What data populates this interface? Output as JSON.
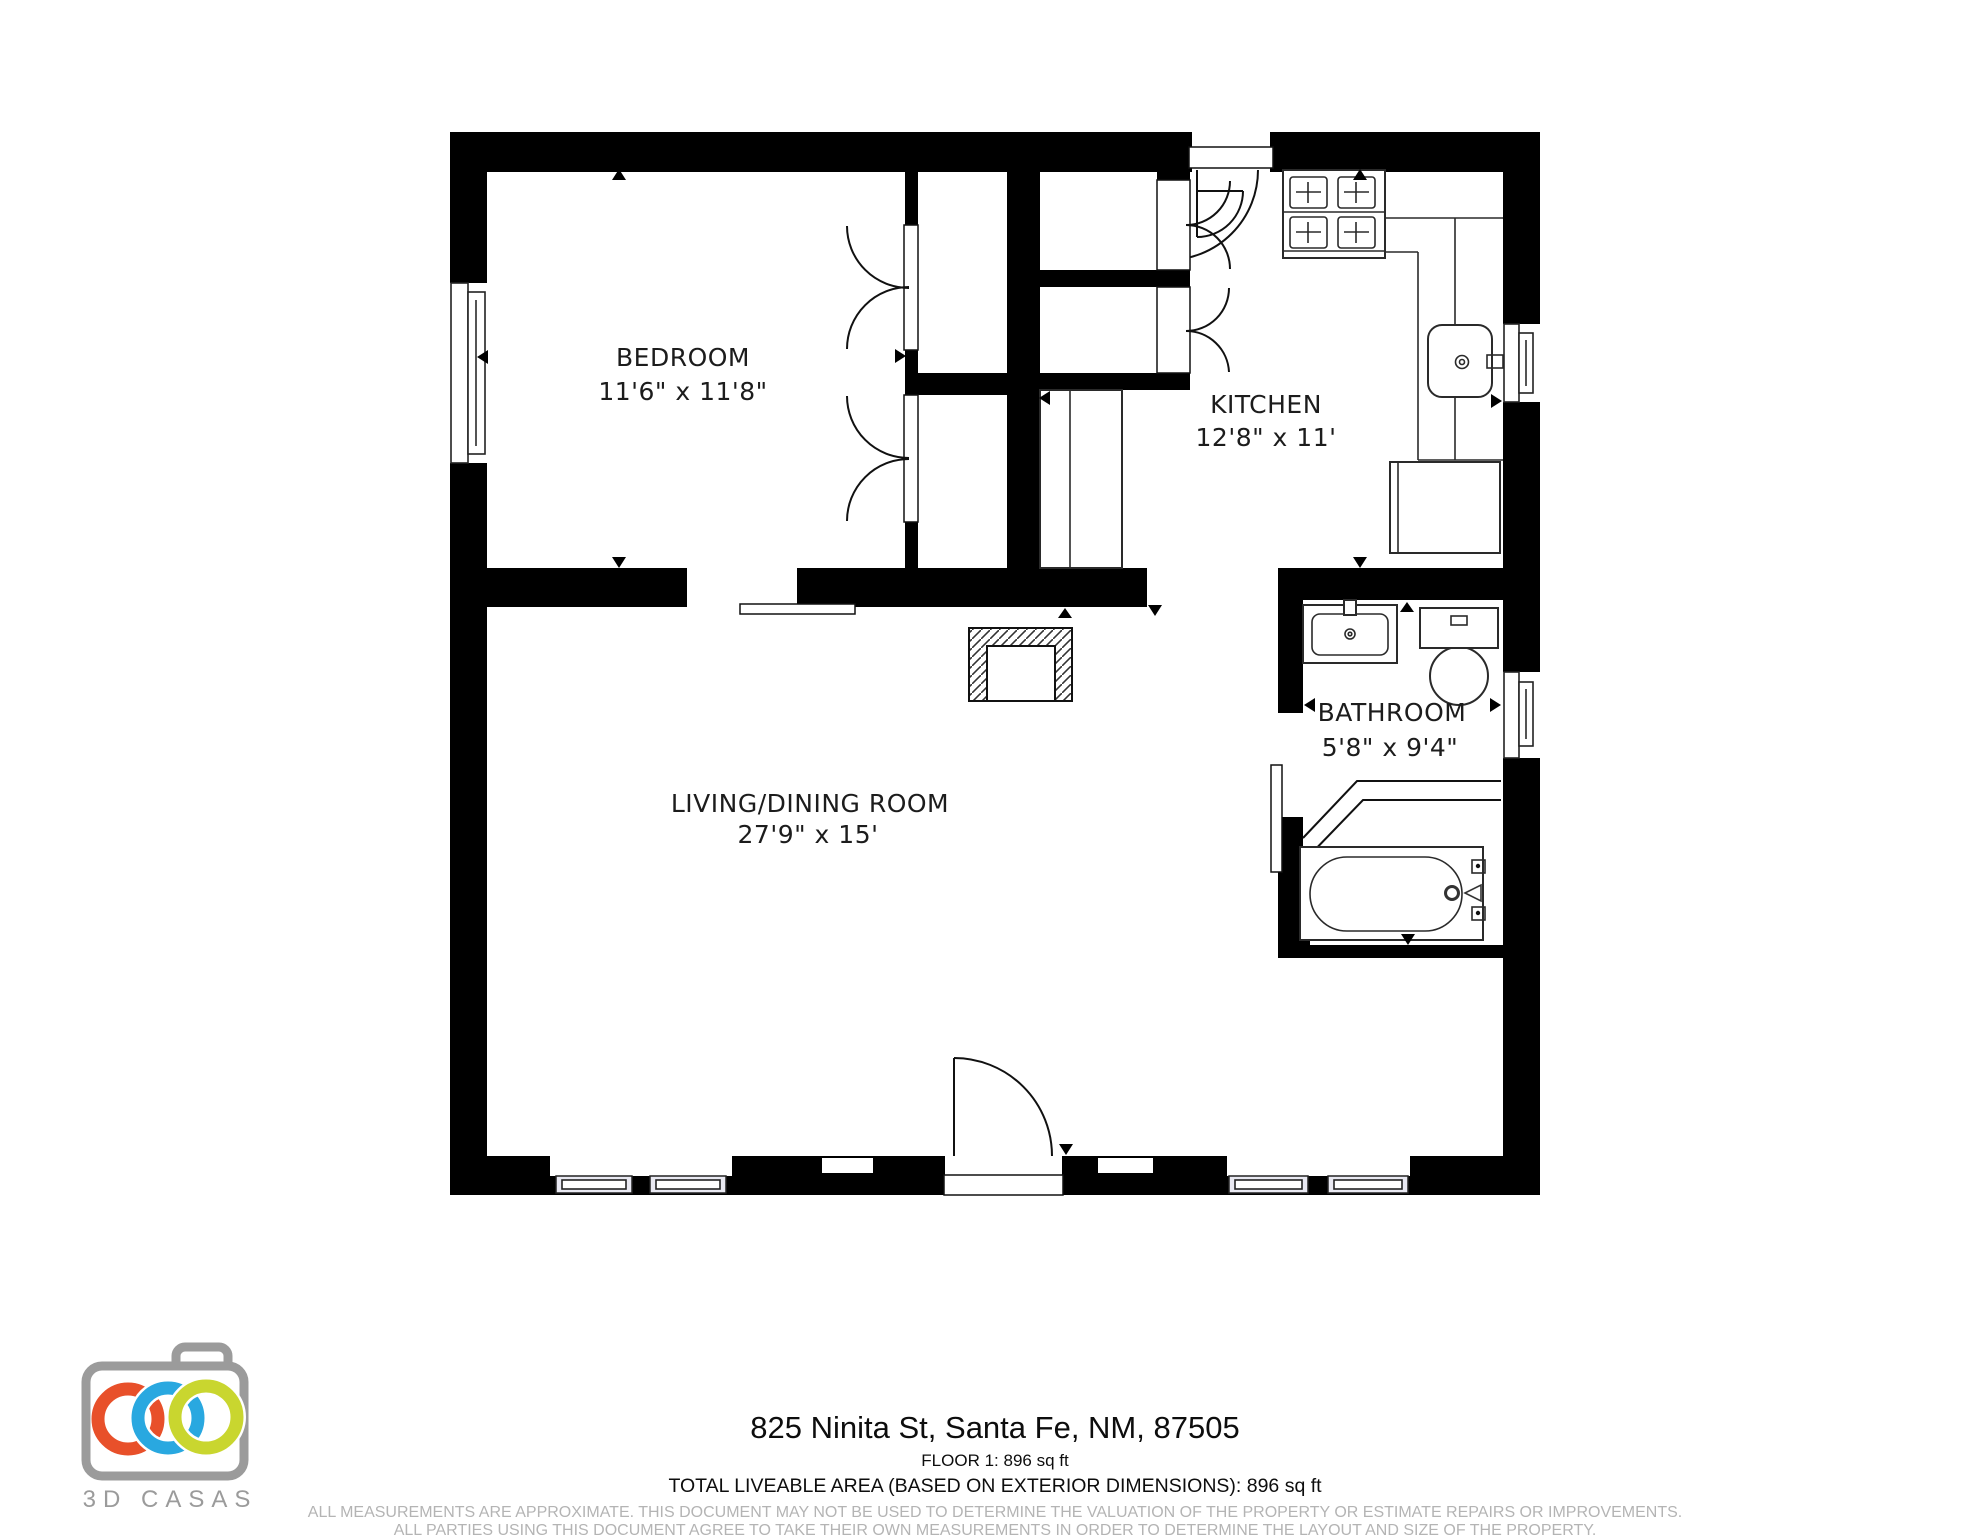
{
  "page": {
    "background": "#ffffff"
  },
  "branding": {
    "logo_text": "3D CASAS",
    "camera_outline_color": "#9b9b9b",
    "ring_colors": {
      "left": "#e8502a",
      "middle": "#29a8e0",
      "right": "#c9d62f"
    },
    "text_color": "#9b9b9b"
  },
  "floor_plan": {
    "wall_color": "#000000",
    "rooms": [
      {
        "name": "BEDROOM",
        "dimensions": "11'6\" x 11'8\""
      },
      {
        "name": "KITCHEN",
        "dimensions": "12'8\" x 11'"
      },
      {
        "name": "BATHROOM",
        "dimensions": "5'8\" x 9'4\""
      },
      {
        "name": "LIVING/DINING ROOM",
        "dimensions": "27'9\" x 15'"
      }
    ],
    "fixtures": [
      "stove",
      "kitchen-sink",
      "refrigerator",
      "pantry-cabinet",
      "fireplace",
      "bathroom-sink",
      "toilet",
      "bathtub",
      "closet-bifold-doors",
      "entry-doors",
      "sliding-doors",
      "windows"
    ]
  },
  "footer": {
    "address": "825 Ninita St, Santa Fe, NM, 87505",
    "floor_info": "FLOOR 1: 896 sq ft",
    "total_area": "TOTAL LIVEABLE AREA (BASED ON EXTERIOR DIMENSIONS): 896 sq ft",
    "disclaimer_line1": "ALL MEASUREMENTS ARE APPROXIMATE. THIS DOCUMENT MAY NOT BE USED TO DETERMINE THE VALUATION OF THE PROPERTY OR ESTIMATE REPAIRS OR IMPROVEMENTS.",
    "disclaimer_line2": "ALL PARTIES USING THIS DOCUMENT AGREE TO TAKE THEIR OWN MEASUREMENTS IN ORDER TO DETERMINE THE LAYOUT AND SIZE OF THE PROPERTY."
  }
}
